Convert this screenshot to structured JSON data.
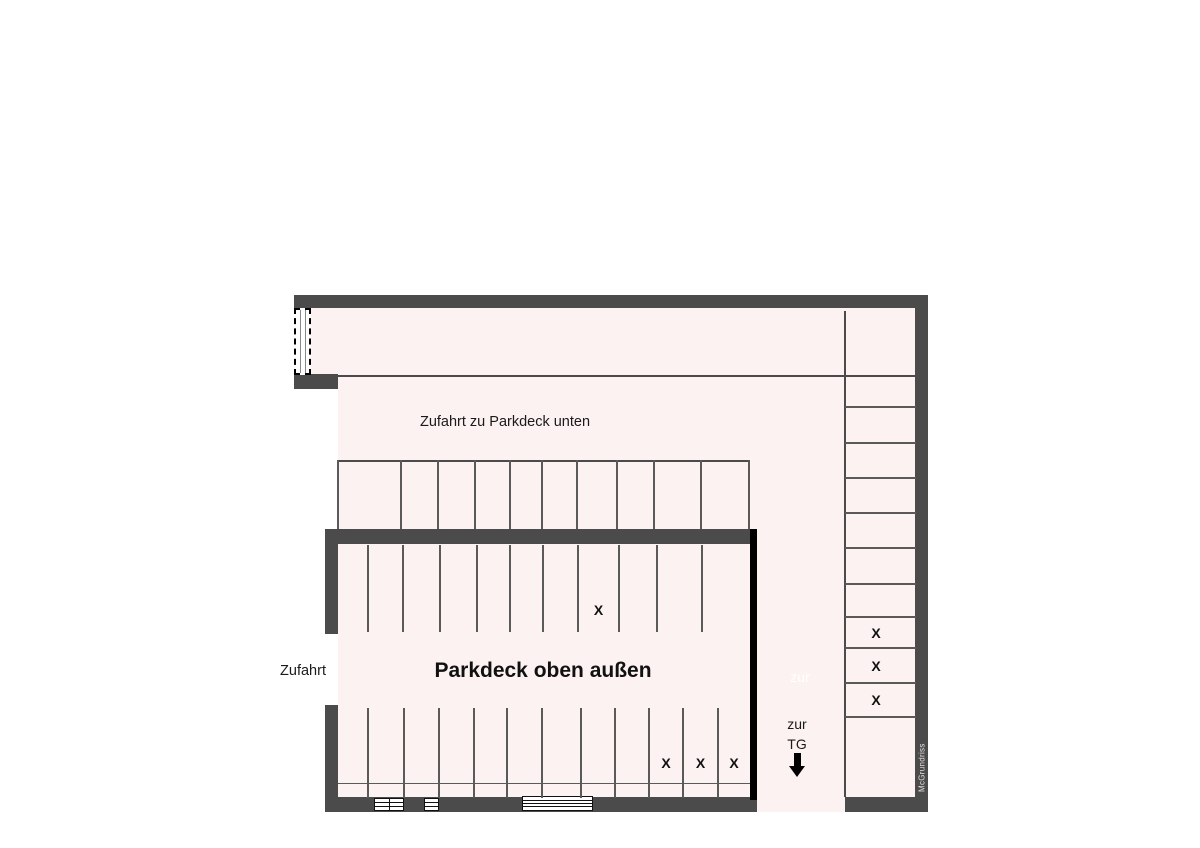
{
  "plan": {
    "title": "Parkdeck oben außen",
    "watermark": "McGrundriss",
    "marker_glyph": "X",
    "labels": {
      "upper_lane": "Zufahrt zu Parkdeck unten",
      "entrance_left": "Zufahrt",
      "to_underground_line1": "zur",
      "to_underground_line2": "TG",
      "ghost_text": "zur"
    },
    "colors": {
      "wall": "#4b4b4b",
      "floor": "#fdf2f2",
      "divider": "#5a5a5a",
      "inner_right_wall": "#000000",
      "text": "#1a1a1a"
    },
    "parking_rows": [
      {
        "id": "outer_top_row",
        "orientation": "vertical",
        "spaces": 10,
        "marked_spaces": []
      },
      {
        "id": "inner_top_row",
        "orientation": "vertical",
        "spaces": 11,
        "marked_spaces": [
          7
        ]
      },
      {
        "id": "inner_bottom_row",
        "orientation": "vertical",
        "spaces": 12,
        "marked_spaces": [
          9,
          10,
          11
        ]
      },
      {
        "id": "right_column",
        "orientation": "horizontal",
        "spaces": 12,
        "marked_spaces": [
          8,
          9,
          10
        ]
      }
    ]
  }
}
